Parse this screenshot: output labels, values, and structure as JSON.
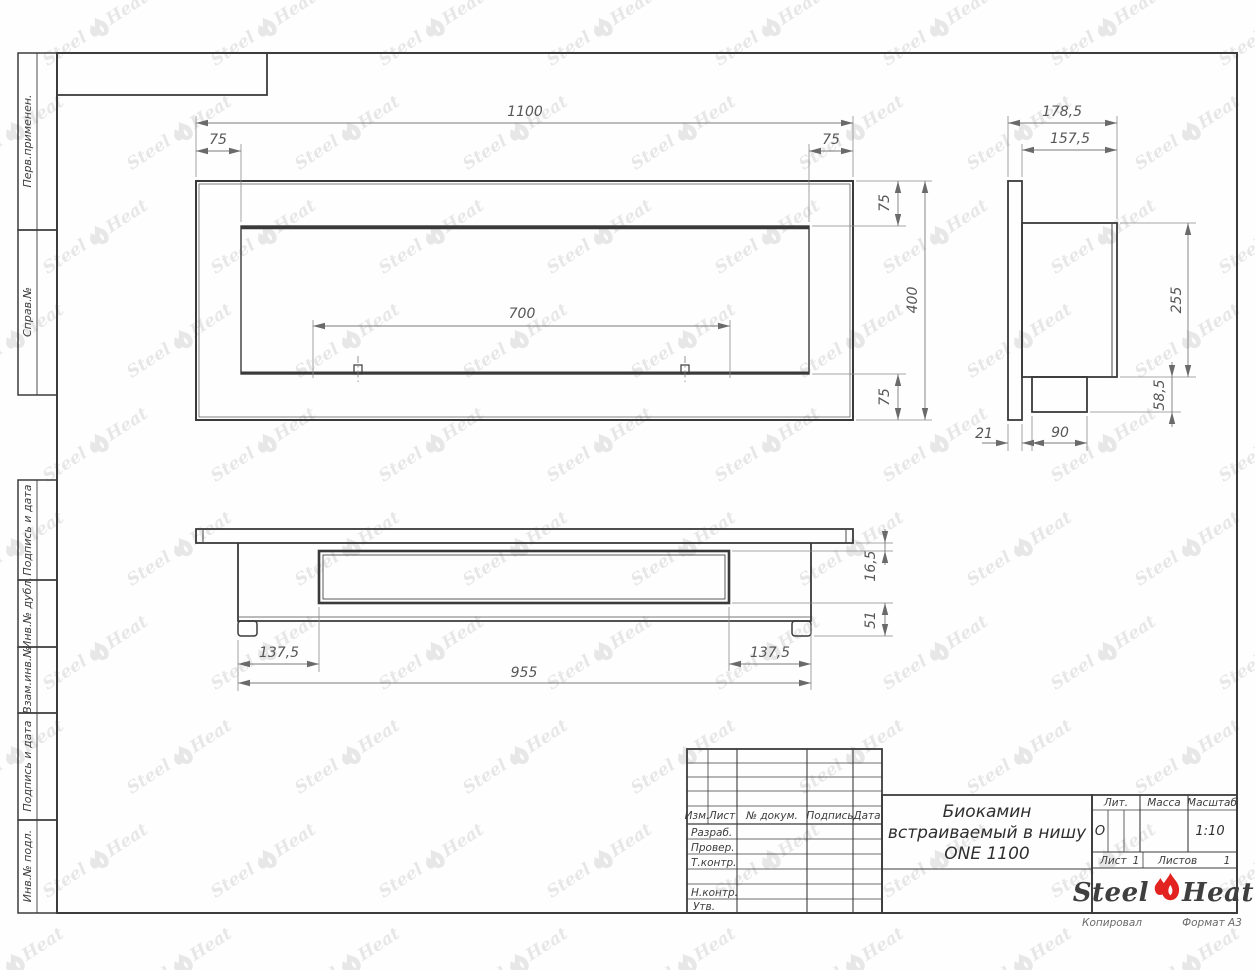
{
  "sheet": {
    "copied_label": "Копировал",
    "format_label": "Формат А3"
  },
  "watermark": {
    "steel": "Steel",
    "heat": "Heat"
  },
  "margin": {
    "boxes": [
      {
        "label": "Перв.применен."
      },
      {
        "label": "Справ.№"
      },
      {
        "label": "Подпись и дата"
      },
      {
        "label": "Инв.№ дубл."
      },
      {
        "label": "Взам.инв.№"
      },
      {
        "label": "Подпись и дата"
      },
      {
        "label": "Инв.№ подл."
      }
    ]
  },
  "title_block": {
    "cols": {
      "izm": "Изм.",
      "list": "Лист",
      "doc": "№ докум.",
      "sign": "Подпись",
      "date": "Дата"
    },
    "rows": {
      "razrab": "Разраб.",
      "prover": "Провер.",
      "tkontr": "Т.контр.",
      "nkontr": "Н.контр.",
      "utv": "Утв."
    },
    "title_lines": [
      "Биокамин",
      "встраиваемый в нишу",
      "ONE 1100"
    ],
    "lit_label": "Лит.",
    "lit_value": "О",
    "mass_label": "Масса",
    "scale_label": "Масштаб",
    "scale_value": "1:10",
    "sheet_label": "Лист",
    "sheet_value": "1",
    "sheets_label": "Листов",
    "sheets_value": "1",
    "logo": {
      "steel": "Steel",
      "heat": "Heat"
    }
  },
  "dims": {
    "front": {
      "total_w": "1100",
      "inset_l": "75",
      "inset_r": "75",
      "opening_w": "700",
      "inset_t": "75",
      "total_h": "400",
      "inset_b": "75"
    },
    "side": {
      "depth_total": "178,5",
      "depth_body": "157,5",
      "body_h": "255",
      "burner_h": "58,5",
      "flange_t": "21",
      "burner_d": "90"
    },
    "plan": {
      "lip": "16,5",
      "foot": "51",
      "offset_l": "137,5",
      "offset_r": "137,5",
      "body_w": "955"
    }
  }
}
